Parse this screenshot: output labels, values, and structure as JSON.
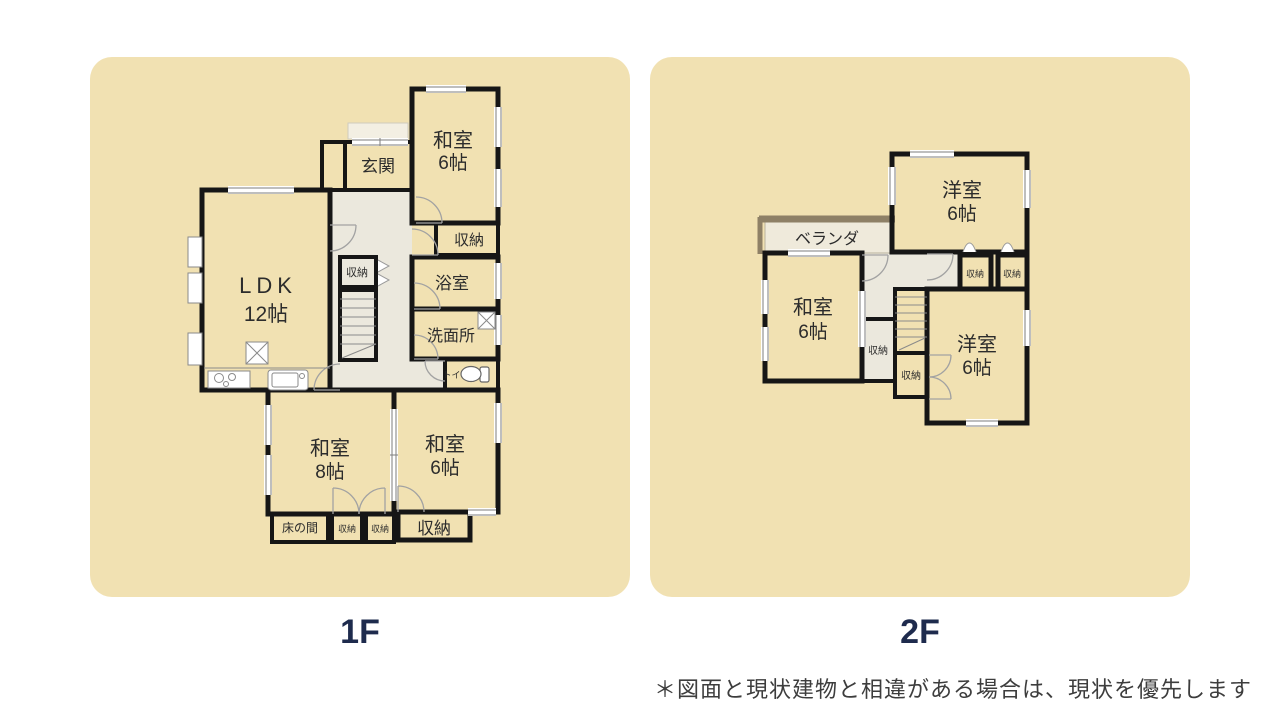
{
  "floors": [
    {
      "caption": "1F",
      "rooms": {
        "genkan": "玄関",
        "washitsu_ne": {
          "name": "和室",
          "size": "6帖"
        },
        "closet_ne": "収納",
        "ldk": {
          "name": "LDK",
          "size": "12帖"
        },
        "closet_hall": "収納",
        "bath": "浴室",
        "washroom": "洗面所",
        "toilet": "トイレ",
        "washitsu_sw": {
          "name": "和室",
          "size": "8帖"
        },
        "washitsu_se": {
          "name": "和室",
          "size": "6帖"
        },
        "tokonoma": "床の間",
        "closet_s1": "収納",
        "closet_s2": "収納",
        "closet_se": "収納"
      }
    },
    {
      "caption": "2F",
      "rooms": {
        "veranda": "ベランダ",
        "yoshitsu_n": {
          "name": "洋室",
          "size": "6帖"
        },
        "washitsu": {
          "name": "和室",
          "size": "6帖"
        },
        "closet_w": "収納",
        "closet_n1": "収納",
        "closet_n2": "収納",
        "closet_s": "収納",
        "yoshitsu_s": {
          "name": "洋室",
          "size": "6帖"
        }
      }
    }
  ],
  "note": "＊図面と現状建物と相違がある場合は、現状を優先します",
  "colors": {
    "panel_bg": "#f1e1b2",
    "caption": "#1e2b4d",
    "wall": "#161616",
    "tatami_room": "#ffffff",
    "cream_room": "#fbf6e5",
    "wet_room": "#e3edf4",
    "hall": "#ebe8dd",
    "closet": "#f7f2de",
    "tokonoma": "#f0eee5",
    "veranda_edge": "#8e8066"
  }
}
